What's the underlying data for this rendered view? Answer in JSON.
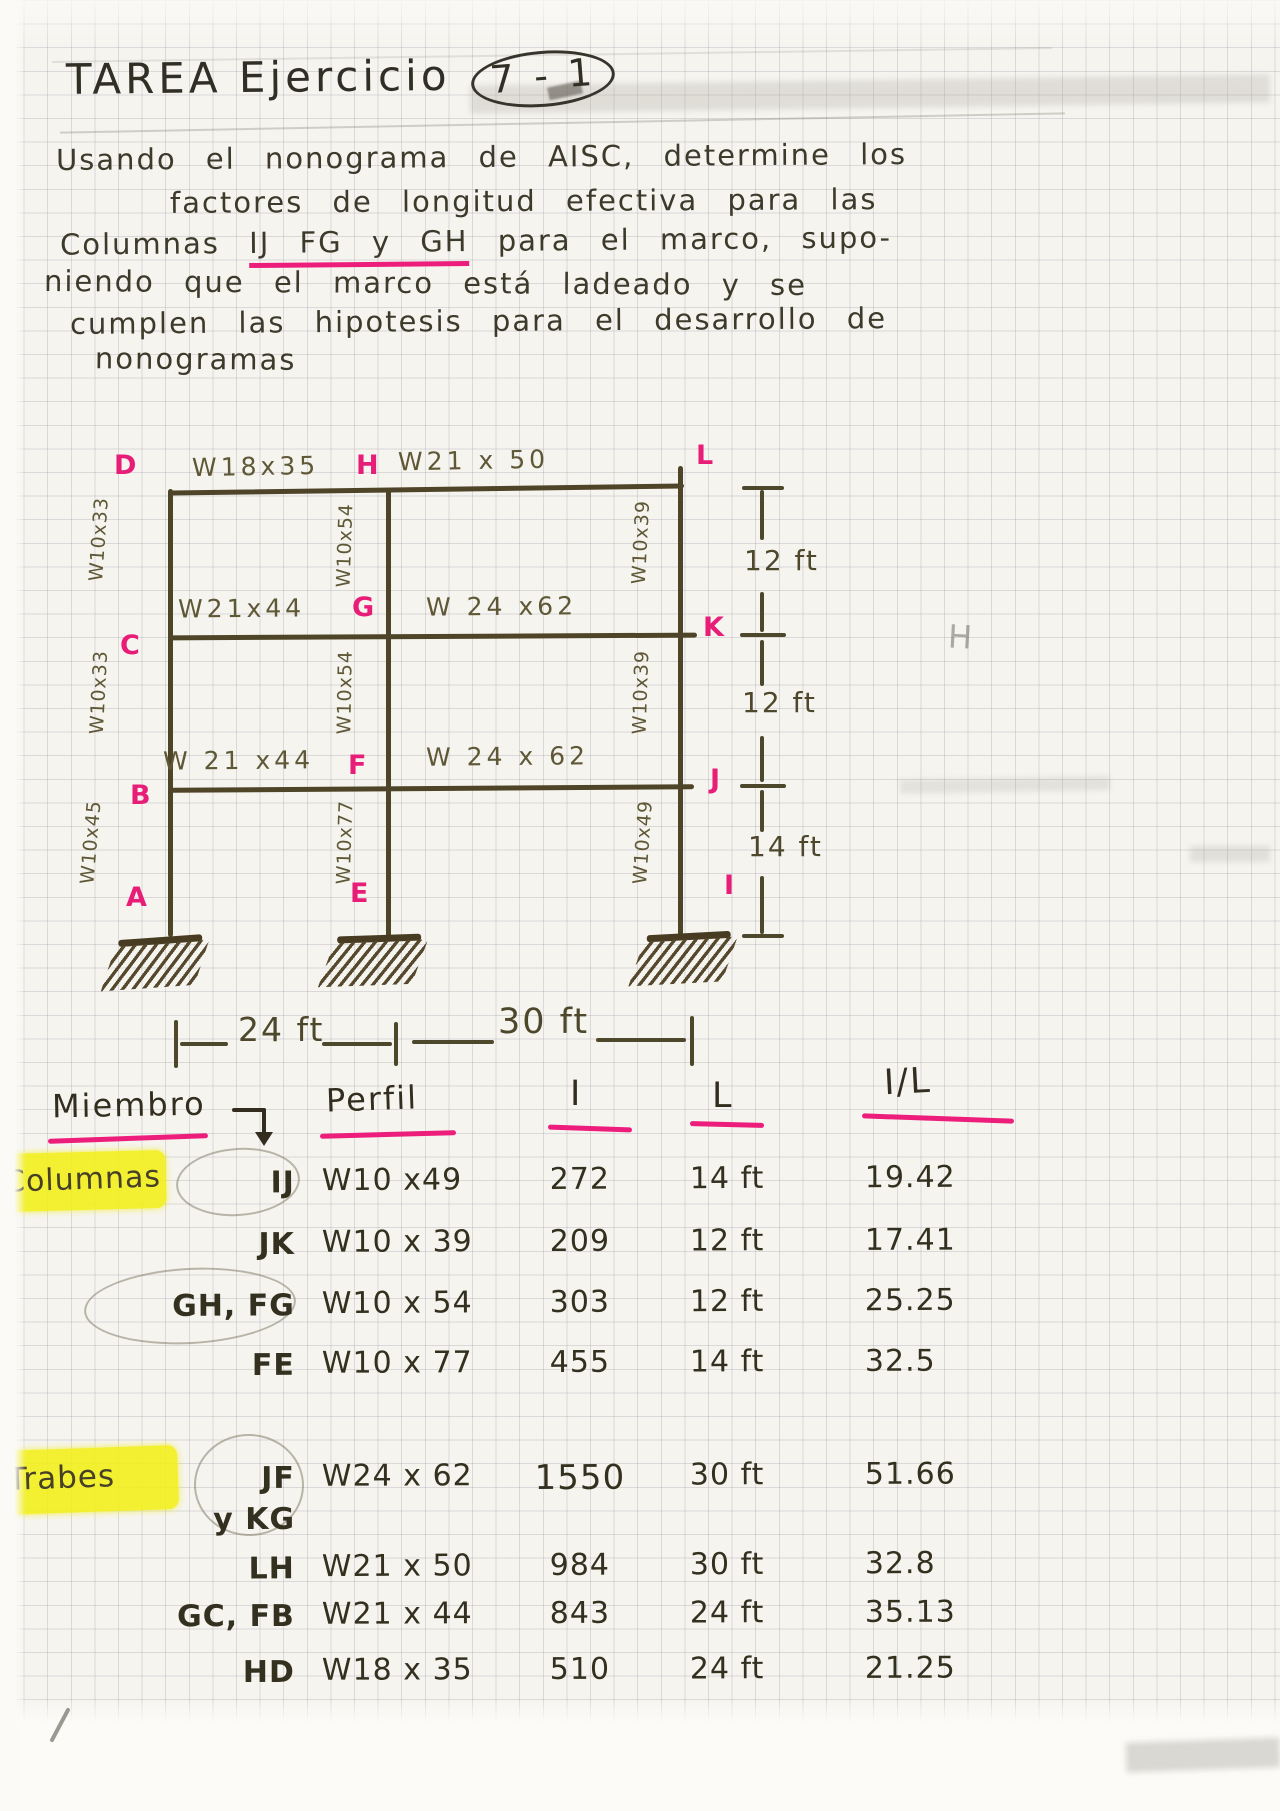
{
  "title": {
    "text": "TAREA Ejercicio",
    "badge": "7 - 1"
  },
  "problem": {
    "line1": "Usando el nonograma de AISC, determine los",
    "line2": "factores de longitud efectiva para las",
    "line3_pre": "Columnas",
    "line3_highlight": "IJ FG y GH",
    "line3_post": "para el marco, supo-",
    "line4": "niendo que el marco está ladeado y se",
    "line5": "cumplen las hipotesis para el desarrollo de",
    "line6": "nonogramas"
  },
  "diagram": {
    "nodes": {
      "D": "D",
      "H": "H",
      "L": "L",
      "C": "C",
      "G": "G",
      "K": "K",
      "B": "B",
      "F": "F",
      "J": "J",
      "A": "A",
      "E": "E",
      "I": "I"
    },
    "beams": {
      "dh": "W18x35",
      "hl": "W21 x 50",
      "cg": "W21x44",
      "gk": "W 24 x62",
      "bf": "W 21 x44",
      "fj": "W 24 x 62"
    },
    "columns": {
      "dc": "W10x33",
      "cb": "W10x33",
      "ba": "W10x45",
      "hg": "W10x54",
      "gf": "W10x54",
      "fe": "W10x77",
      "lk": "W10x39",
      "kj": "W10x39",
      "ji": "W10x49"
    },
    "dims": {
      "story1": "12 ft",
      "story2": "12 ft",
      "story3": "14 ft",
      "bay1": "24 ft",
      "bay2": "30 ft"
    },
    "pencil": {
      "h": "H"
    }
  },
  "table": {
    "headers": {
      "member": "Miembro",
      "perfil": "Perfil",
      "inertia": "I",
      "length": "L",
      "ratio": "I/L"
    },
    "groups": [
      {
        "label": "Columnas",
        "rows": [
          {
            "member": "IJ",
            "perfil": "W10 x49",
            "I": "272",
            "L": "14 ft",
            "IL": "19.42"
          },
          {
            "member": "JK",
            "perfil": "W10 x 39",
            "I": "209",
            "L": "12 ft",
            "IL": "17.41"
          },
          {
            "member": "GH, FG",
            "perfil": "W10 x 54",
            "I": "303",
            "L": "12 ft",
            "IL": "25.25"
          },
          {
            "member": "FE",
            "perfil": "W10 x 77",
            "I": "455",
            "L": "14 ft",
            "IL": "32.5"
          }
        ]
      },
      {
        "label": "Trabes",
        "rows": [
          {
            "member": "JF\ny KG",
            "perfil": "W24 x 62",
            "I": "1550",
            "L": "30 ft",
            "IL": "51.66"
          },
          {
            "member": "LH",
            "perfil": "W21 x 50",
            "I": "984",
            "L": "30 ft",
            "IL": "32.8"
          },
          {
            "member": "GC, FB",
            "perfil": "W21 x 44",
            "I": "843",
            "L": "24 ft",
            "IL": "35.13"
          },
          {
            "member": "HD",
            "perfil": "W18 x 35",
            "I": "510",
            "L": "24 ft",
            "IL": "21.25"
          }
        ]
      }
    ]
  },
  "colors": {
    "ink": "#34301f",
    "pink": "#ec1d7b",
    "yellow": "#f3ef17",
    "frame": "#4e4428"
  }
}
